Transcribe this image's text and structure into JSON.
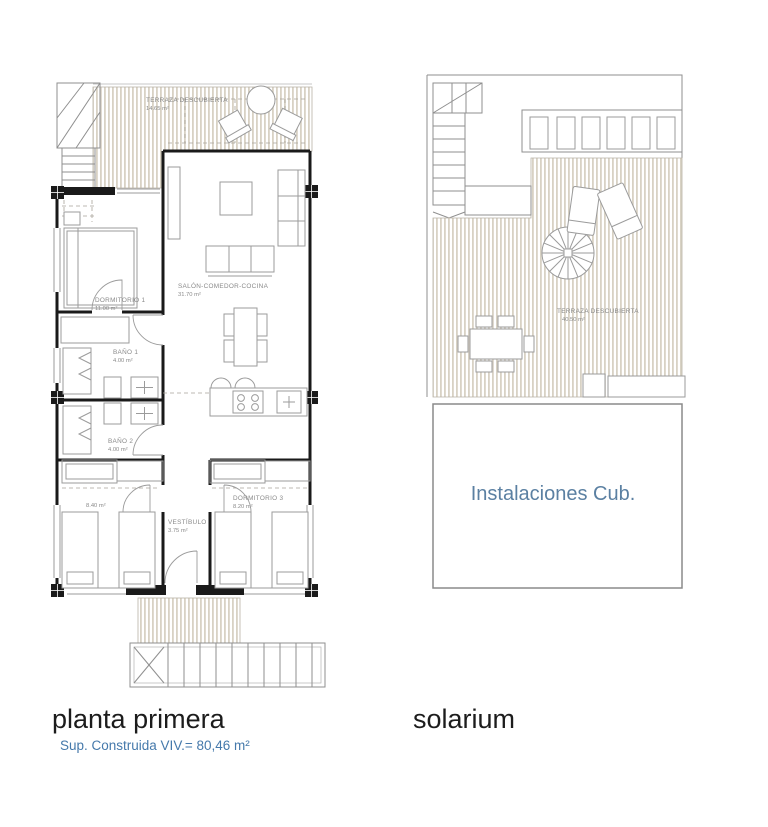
{
  "sheet": {
    "type": "architectural floor plan sheet",
    "plans": {
      "planta_primera": {
        "title": "planta primera",
        "subtitle": "Sup. Construida VIV.= 80,46 m²",
        "rooms": {
          "terraza": {
            "name": "TERRAZA DESCUBIERTA",
            "area": "14.65 m²"
          },
          "dormitorio1": {
            "name": "DORMITORIO 1",
            "area": "11.00 m²"
          },
          "salon": {
            "name": "SALÓN-COMEDOR-COCINA",
            "area": "31.70 m²"
          },
          "bano1": {
            "name": "BAÑO 1",
            "area": "4.00 m²"
          },
          "bano2": {
            "name": "BAÑO 2",
            "area": "4.00 m²"
          },
          "dormitorio2": {
            "area": "8.40 m²"
          },
          "dormitorio3": {
            "name": "DORMITORIO 3",
            "area": "8.20 m²"
          },
          "vestibulo": {
            "name": "VESTÍBULO",
            "area": "3.75 m²"
          }
        }
      },
      "solarium": {
        "title": "solarium",
        "rooms": {
          "terraza": {
            "name": "TERRAZA DESCUBIERTA",
            "area": "40.50 m²"
          },
          "instalaciones": {
            "name": "Instalaciones Cub."
          }
        }
      }
    },
    "colors": {
      "wall": "#1a1a1a",
      "furniture_line": "#9b9b9b",
      "deck_stripe": "#d8d2c4",
      "label_text": "#8a8a8a",
      "title_text": "#1c1c1c",
      "subtitle_blue": "#4579ab",
      "instalaciones_blue": "#5b80a2"
    }
  }
}
